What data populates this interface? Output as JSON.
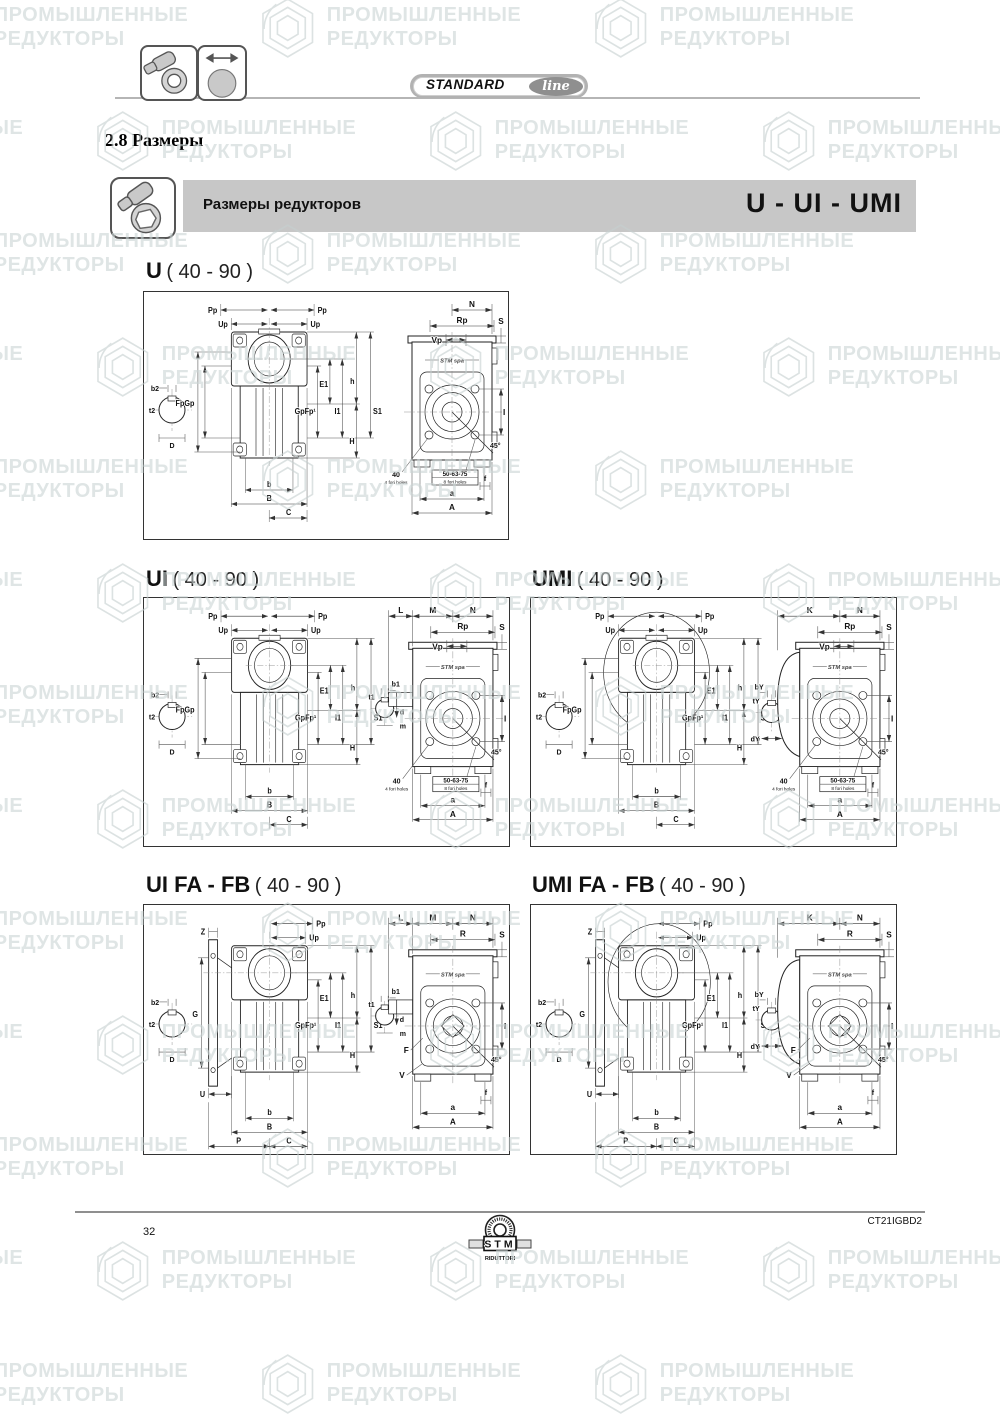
{
  "header": {
    "badge_standard": "STANDARD",
    "badge_line": "line",
    "heading": "2.8 Размеры",
    "bar_title": "Размеры редукторов",
    "bar_models": "U - UI - UMI",
    "icons": {
      "box1": "worm-gearbox-icon",
      "box2": "shaft-dimension-icon",
      "bar": "worm-gearbox-icon"
    }
  },
  "watermark": {
    "line1": "ПРОМЫШЛЕННЫЕ",
    "line2": "РЕДУКТОРЫ"
  },
  "footer": {
    "page_number": "32",
    "doc_code": "CT21IGBD2",
    "logo_name": "STM",
    "logo_sub": "RIDUTTORI"
  },
  "panels": [
    {
      "id": "u",
      "model": "U",
      "range": "( 40 - 90 )",
      "labels": {
        "pp": "Pp",
        "up": "Up",
        "b2": "b2",
        "t2": "t2",
        "D": "D",
        "fpgp": "FpGp",
        "gpfp": "GpFp¹",
        "e1": "E1",
        "i1": "I1",
        "h": "h",
        "s1": "S1",
        "H": "H",
        "b": "b",
        "B": "B",
        "c": "C",
        "n": "N",
        "rp": "Rp",
        "vp": "Vp",
        "s": "S",
        "i": "I",
        "deg": "45°",
        "f40": "40",
        "f40s": "4 fori holes",
        "f50": "50-63-75",
        "f50s": "8 fori holes",
        "f": "f",
        "a": "a",
        "A": "A",
        "stm": "STM spa"
      }
    },
    {
      "id": "ui",
      "model": "UI",
      "range": "( 40 - 90 )",
      "labels": {
        "pp": "Pp",
        "up": "Up",
        "b2": "b2",
        "t2": "t2",
        "D": "D",
        "fpgp": "FpGp",
        "gpfp": "GpFp¹",
        "e1": "E1",
        "i1": "I1",
        "h": "h",
        "s1": "S1",
        "H": "H",
        "b": "b",
        "B": "B",
        "c": "C",
        "l": "L",
        "m": "M",
        "n": "N",
        "rp": "Rp",
        "vp": "Vp",
        "s": "S",
        "i": "I",
        "deg": "45°",
        "f40": "40",
        "f40s": "4 fori holes",
        "f50": "50-63-75",
        "f50s": "8 fori holes",
        "f": "f",
        "a": "a",
        "A": "A",
        "b1": "b1",
        "t1": "t1",
        "d": "d",
        "mi": "m",
        "stm": "STM spa"
      }
    },
    {
      "id": "umi",
      "model": "UMI",
      "range": "( 40 - 90 )",
      "labels": {
        "pp": "Pp",
        "up": "Up",
        "b2": "b2",
        "t2": "t2",
        "D": "D",
        "fpgp": "FpGp",
        "gpfp": "GpFp¹",
        "e1": "E1",
        "i1": "I1",
        "h": "h",
        "s1": "S1",
        "H": "H",
        "b": "b",
        "B": "B",
        "c": "C",
        "k": "K",
        "n": "N",
        "rp": "Rp",
        "vp": "Vp",
        "s": "S",
        "i": "I",
        "deg": "45°",
        "f40": "40",
        "f40s": "4 fori holes",
        "f50": "50-63-75",
        "f50s": "8 fori holes",
        "f": "f",
        "a": "a",
        "A": "A",
        "by": "bY",
        "ty": "tY",
        "y": "Y",
        "dy": "dY",
        "stm": "STM spa"
      }
    },
    {
      "id": "uifafb",
      "model": "UI FA - FB",
      "range": "( 40 - 90 )",
      "labels": {
        "pp": "Pp",
        "up": "Up",
        "b2": "b2",
        "t2": "t2",
        "D": "D",
        "z": "Z",
        "g": "G",
        "u": "U",
        "p": "P",
        "gpfp": "GpFp¹",
        "e1": "E1",
        "i1": "I1",
        "h": "h",
        "s1": "S1",
        "H": "H",
        "b": "b",
        "B": "B",
        "c": "C",
        "l": "L",
        "m": "M",
        "n": "N",
        "r": "R",
        "s": "S",
        "i": "I",
        "deg": "45°",
        "f": "f",
        "a": "a",
        "A": "A",
        "F": "F",
        "v": "V",
        "b1": "b1",
        "t1": "t1",
        "d": "d",
        "mi": "m",
        "stm": "STM spa"
      }
    },
    {
      "id": "umifafb",
      "model": "UMI FA - FB",
      "range": "( 40 - 90 )",
      "labels": {
        "pp": "Pp",
        "up": "Up",
        "b2": "b2",
        "t2": "t2",
        "D": "D",
        "z": "Z",
        "g": "G",
        "u": "U",
        "p": "P",
        "gpfp": "GpFp¹",
        "e1": "E1",
        "i1": "I1",
        "h": "h",
        "s1": "S1",
        "H": "H",
        "b": "b",
        "B": "B",
        "c": "C",
        "k": "K",
        "n": "N",
        "r": "R",
        "s": "S",
        "i": "I",
        "deg": "45°",
        "f": "f",
        "a": "a",
        "A": "A",
        "F": "F",
        "v": "V",
        "by": "bY",
        "ty": "tY",
        "y": "Y",
        "dy": "dY",
        "stm": "STM spa"
      }
    }
  ]
}
